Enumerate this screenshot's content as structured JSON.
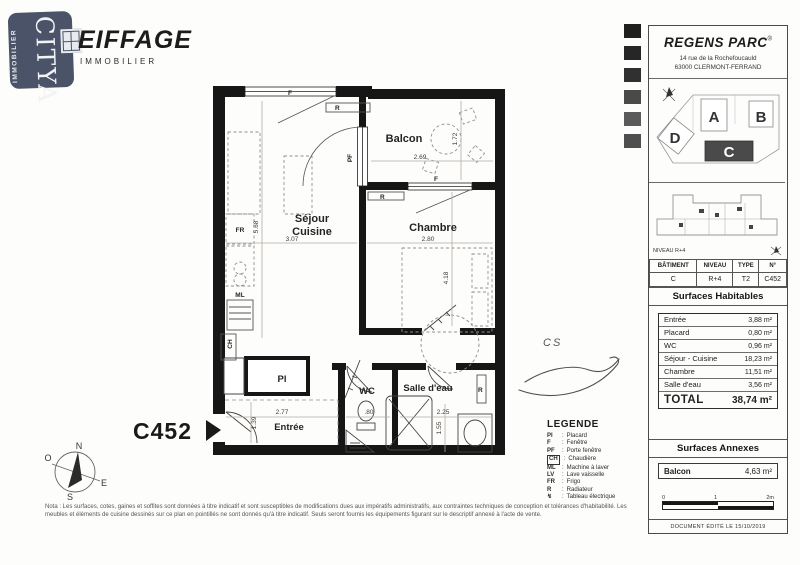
{
  "branding": {
    "citya": {
      "name": "CITYA",
      "subtitle": "IMMOBILIER"
    },
    "eiffage": {
      "name": "EIFFAGE",
      "subtitle": "IMMOBILIER"
    }
  },
  "side_panel": {
    "program": {
      "name": "REGENS PARC",
      "reg": "®",
      "address1": "14 rue de la Rochefoucauld",
      "address2": "63000 CLERMONT-FERRAND"
    },
    "site_plan": {
      "building_a": "A",
      "building_b": "B",
      "building_c": "C",
      "building_d": "D"
    },
    "level_caption": "NIVEAU R+4",
    "unit_table": {
      "headers": [
        "BÂTIMENT",
        "NIVEAU",
        "TYPE",
        "N°"
      ],
      "values": [
        "C",
        "R+4",
        "T2",
        "C452"
      ]
    },
    "surfaces_habitables": {
      "title": "Surfaces Habitables",
      "rows": [
        {
          "label": "Entrée",
          "value": "3,88 m²"
        },
        {
          "label": "Placard",
          "value": "0,80 m²"
        },
        {
          "label": "WC",
          "value": "0,96 m²"
        },
        {
          "label": "Séjour - Cuisine",
          "value": "18,23 m²"
        },
        {
          "label": "Chambre",
          "value": "11,51 m²"
        },
        {
          "label": "Salle d'eau",
          "value": "3,56 m²"
        }
      ],
      "total": {
        "label": "TOTAL",
        "value": "38,74 m²"
      }
    },
    "surfaces_annexes": {
      "title": "Surfaces Annexes",
      "rows": [
        {
          "label": "Balcon",
          "value": "4,63 m²"
        }
      ]
    },
    "scale_bar": {
      "t0": "0",
      "t1": "1",
      "t2": "2m"
    },
    "edited": "DOCUMENT ÉDITÉ LE 15/10/2019"
  },
  "plan": {
    "unit_number": "C452",
    "rooms": {
      "sejour": {
        "line1": "Séjour",
        "line2": "Cuisine",
        "width": "3.07",
        "height": "5.68"
      },
      "chambre": {
        "label": "Chambre",
        "width": "2.80",
        "height": "4.18"
      },
      "balcon": {
        "label": "Balcon",
        "width": "2.69",
        "height": "1.72"
      },
      "entree": {
        "label": "Entrée",
        "width": "2.77",
        "height": "1.39"
      },
      "wc": {
        "label": "WC",
        "width": ".80"
      },
      "salle_eau": {
        "label": "Salle d'eau",
        "width": "2.25",
        "height": "1.55"
      },
      "placard": {
        "label": "Pl"
      }
    },
    "marks": {
      "fr": "FR",
      "ml": "ML",
      "ch": "CH",
      "r": "R",
      "f": "F",
      "pf": "PF"
    },
    "signature_initials": "CS"
  },
  "legend": {
    "title": "LEGENDE",
    "sep": ":",
    "items": [
      {
        "key": "Pl",
        "desc": "Placard"
      },
      {
        "key": "F",
        "desc": "Fenêtre"
      },
      {
        "key": "PF",
        "desc": "Porte fenêtre"
      },
      {
        "key": "CH",
        "desc": "Chaudière"
      },
      {
        "key": "ML",
        "desc": "Machine à laver"
      },
      {
        "key": "LV",
        "desc": "Lave vaisselle"
      },
      {
        "key": "FR",
        "desc": "Frigo"
      },
      {
        "key": "R",
        "desc": "Radiateur"
      },
      {
        "key": "↯",
        "desc": "Tableau électrique"
      }
    ]
  },
  "compass": {
    "n": "N",
    "s": "S",
    "e": "E",
    "o": "O"
  },
  "disclaimer": "Nota : Les surfaces, cotes, gaines et soffites sont données à titre indicatif et sont susceptibles de modifications dues aux impératifs administratifs, aux contraintes techniques de conception et tolérances d'habitabilité. Les meubles et éléments de cuisine dessinés sur ce plan en pointillés ne sont donnés qu'à titre indicatif. Seuls seront fournis les équipements figurant sur le descriptif annexé à l'acte de vente."
}
